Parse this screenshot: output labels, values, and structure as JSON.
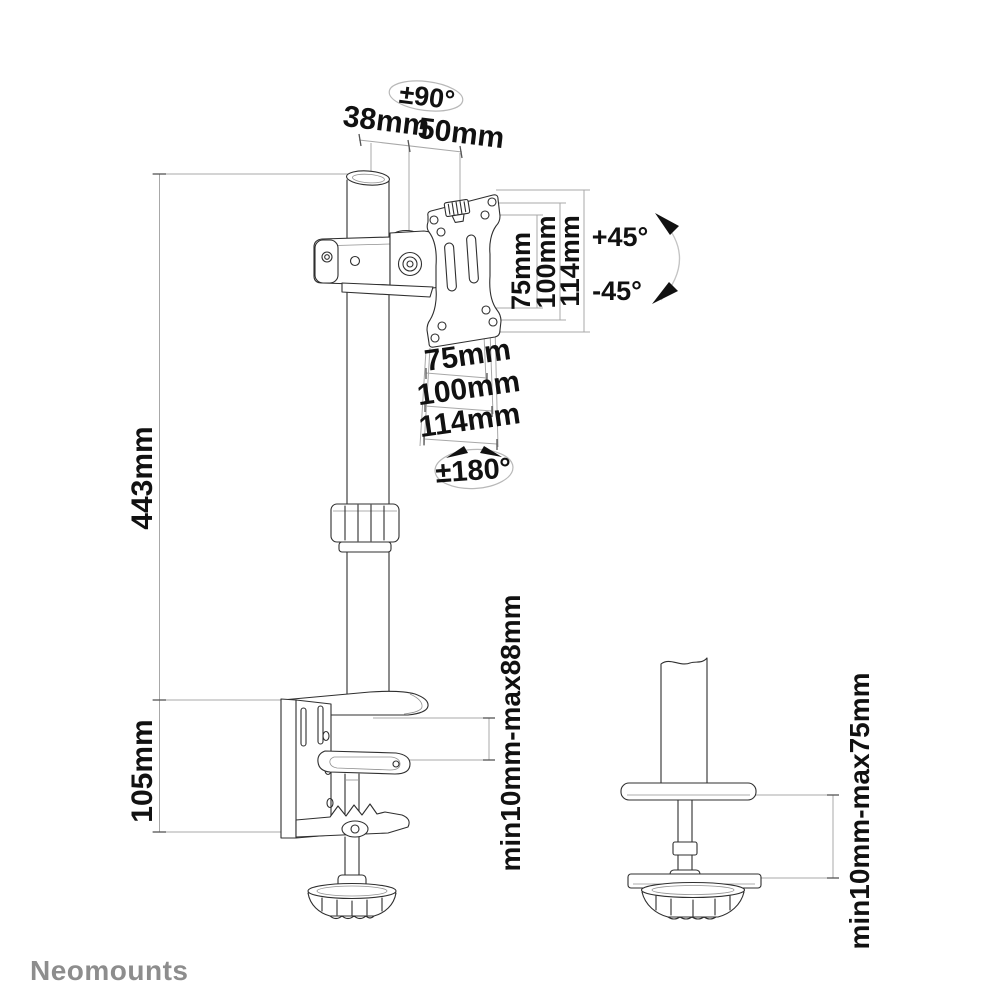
{
  "colors": {
    "background": "#ffffff",
    "line_art": "#2f2f2f",
    "dimension_lines": "#a8a8a8",
    "label_text": "#111111",
    "brand_gray": "#8d8d8d"
  },
  "brand": {
    "logo_text": "Neomounts"
  },
  "annotations": {
    "pole_swivel_range": "±90°",
    "pole_diameter": "38mm",
    "arm_offset": "50mm",
    "tilt_up": "+45°",
    "tilt_down": "-45°",
    "vesa_vertical": {
      "v75": "75mm",
      "v100": "100mm",
      "v114": "114mm"
    },
    "vesa_horizontal": {
      "h75": "75mm",
      "h100": "100mm",
      "h114": "114mm"
    },
    "vesa_rotation_range": "±180°",
    "pole_height": "443mm",
    "clamp_bracket_height": "105mm",
    "clamp_desk_thickness": "min10mm-max88mm",
    "grommet_desk_thickness": "min10mm-max75mm"
  }
}
